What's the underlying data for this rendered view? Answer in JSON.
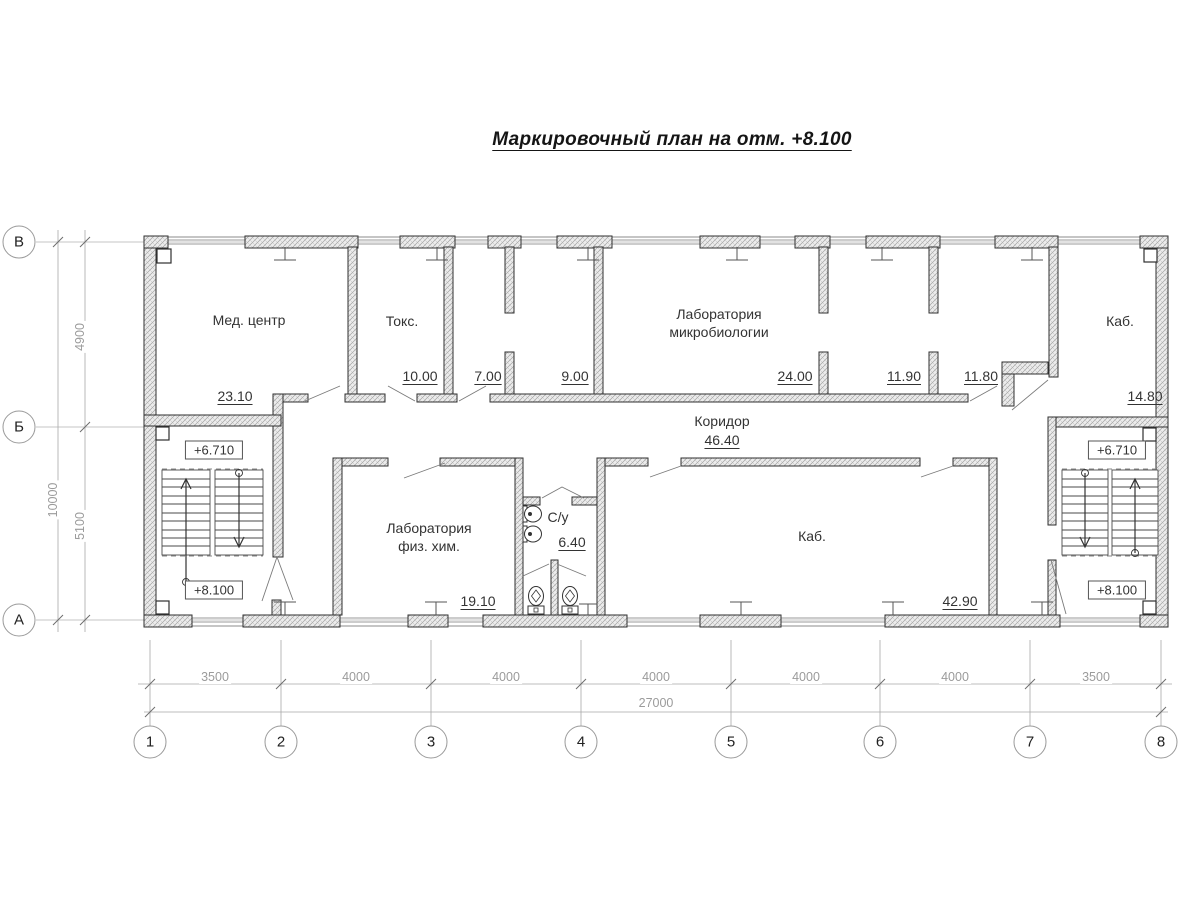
{
  "title": "Маркировочный план на отм. +8.100",
  "rooms": {
    "med_center": {
      "name": "Мед. центр",
      "area": "23.10"
    },
    "toks": {
      "name": "Токс.",
      "area": "10.00"
    },
    "room_7": {
      "area": "7.00"
    },
    "room_9": {
      "area": "9.00"
    },
    "lab_micro": {
      "name": "Лаборатория микробиологии",
      "area": "24.00"
    },
    "room_1190": {
      "area": "11.90"
    },
    "room_1180": {
      "area": "11.80"
    },
    "kab_top": {
      "name": "Каб.",
      "area": "14.80"
    },
    "koridor": {
      "name": "Коридор",
      "area": "46.40"
    },
    "lab_fiz": {
      "name": "Лаборатория физ. хим.",
      "area": "19.10"
    },
    "su": {
      "name": "С/у",
      "area": "6.40"
    },
    "kab_bottom": {
      "name": "Каб.",
      "area": "42.90"
    }
  },
  "elevations": {
    "left_upper": "+6.710",
    "left_lower": "+8.100",
    "right_upper": "+6.710",
    "right_lower": "+8.100"
  },
  "grid": {
    "columns": [
      "1",
      "2",
      "3",
      "4",
      "5",
      "6",
      "7",
      "8"
    ],
    "rows": [
      "В",
      "Б",
      "А"
    ],
    "col_dims": [
      "3500",
      "4000",
      "4000",
      "4000",
      "4000",
      "4000",
      "3500"
    ],
    "col_total": "27000",
    "row_dims": [
      "4900",
      "5100"
    ],
    "row_total": "10000"
  },
  "colors": {
    "wall_fill": "#ececec",
    "wall_hatch": "#a3a3a3",
    "wall_stroke": "#2f2f2f",
    "thin_line": "#a8a8a8",
    "dim_text": "#9b9b9b",
    "label_text": "#333333"
  }
}
